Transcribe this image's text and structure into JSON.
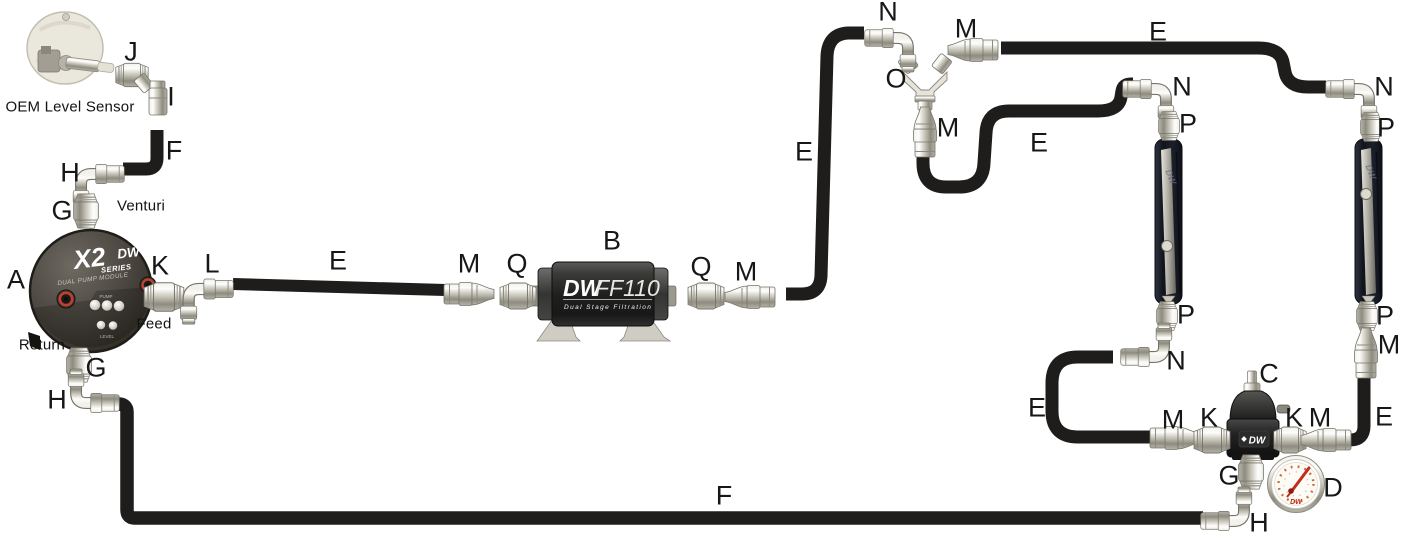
{
  "diagram_title": "Fuel system plumbing diagram",
  "captions": {
    "oem_level_sensor": "OEM Level Sensor",
    "venturi": "Venturi",
    "feed": "Feed",
    "return": "Return"
  },
  "devices": {
    "pump_module": {
      "brand": "X2",
      "brand_suffix": "SERIES",
      "brand_dw": "DW",
      "subtitle": "DUAL PUMP MODULE",
      "pump_text": "PUMP",
      "level_text": "LEVEL"
    },
    "filter": {
      "brand_dw": "DW",
      "model": "FF110",
      "subtitle": "Dual Stage Filtration"
    },
    "regulator": {
      "brand_dw": "DW"
    },
    "gauge": {
      "brand_dw": "DW"
    },
    "rail": {
      "brand_dw": "DW"
    }
  },
  "colors": {
    "hose": "#1e1d1b",
    "label_text": "#171717",
    "fitting_silver": "#d6d4ca",
    "oring_red": "#c04030",
    "gauge_accent": "#c96a35",
    "brand_red": "#c32b1a"
  },
  "part_labels": [
    {
      "text": "J",
      "x": 131,
      "y": 52
    },
    {
      "text": "I",
      "x": 171,
      "y": 97
    },
    {
      "text": "F",
      "x": 174,
      "y": 151
    },
    {
      "text": "H",
      "x": 70,
      "y": 173
    },
    {
      "text": "G",
      "x": 62,
      "y": 211
    },
    {
      "text": "A",
      "x": 16,
      "y": 280
    },
    {
      "text": "K",
      "x": 160,
      "y": 266
    },
    {
      "text": "L",
      "x": 212,
      "y": 264
    },
    {
      "text": "E",
      "x": 338,
      "y": 261
    },
    {
      "text": "M",
      "x": 469,
      "y": 264
    },
    {
      "text": "Q",
      "x": 517,
      "y": 264
    },
    {
      "text": "B",
      "x": 612,
      "y": 241
    },
    {
      "text": "Q",
      "x": 701,
      "y": 267
    },
    {
      "text": "M",
      "x": 746,
      "y": 272
    },
    {
      "text": "G",
      "x": 96,
      "y": 368
    },
    {
      "text": "H",
      "x": 57,
      "y": 400
    },
    {
      "text": "E",
      "x": 804,
      "y": 152
    },
    {
      "text": "N",
      "x": 888,
      "y": 12
    },
    {
      "text": "M",
      "x": 966,
      "y": 29
    },
    {
      "text": "O",
      "x": 896,
      "y": 79
    },
    {
      "text": "M",
      "x": 948,
      "y": 128
    },
    {
      "text": "E",
      "x": 1158,
      "y": 32
    },
    {
      "text": "E",
      "x": 1039,
      "y": 143
    },
    {
      "text": "N",
      "x": 1182,
      "y": 87
    },
    {
      "text": "P",
      "x": 1188,
      "y": 124
    },
    {
      "text": "N",
      "x": 1384,
      "y": 87
    },
    {
      "text": "P",
      "x": 1386,
      "y": 128
    },
    {
      "text": "P",
      "x": 1186,
      "y": 315
    },
    {
      "text": "N",
      "x": 1176,
      "y": 361
    },
    {
      "text": "P",
      "x": 1385,
      "y": 316
    },
    {
      "text": "M",
      "x": 1389,
      "y": 345
    },
    {
      "text": "E",
      "x": 1037,
      "y": 408
    },
    {
      "text": "C",
      "x": 1269,
      "y": 374
    },
    {
      "text": "M",
      "x": 1173,
      "y": 420
    },
    {
      "text": "K",
      "x": 1209,
      "y": 418
    },
    {
      "text": "K",
      "x": 1294,
      "y": 418
    },
    {
      "text": "M",
      "x": 1320,
      "y": 418
    },
    {
      "text": "E",
      "x": 1384,
      "y": 417
    },
    {
      "text": "G",
      "x": 1229,
      "y": 476
    },
    {
      "text": "D",
      "x": 1333,
      "y": 488
    },
    {
      "text": "H",
      "x": 1259,
      "y": 523
    },
    {
      "text": "F",
      "x": 724,
      "y": 496
    }
  ]
}
